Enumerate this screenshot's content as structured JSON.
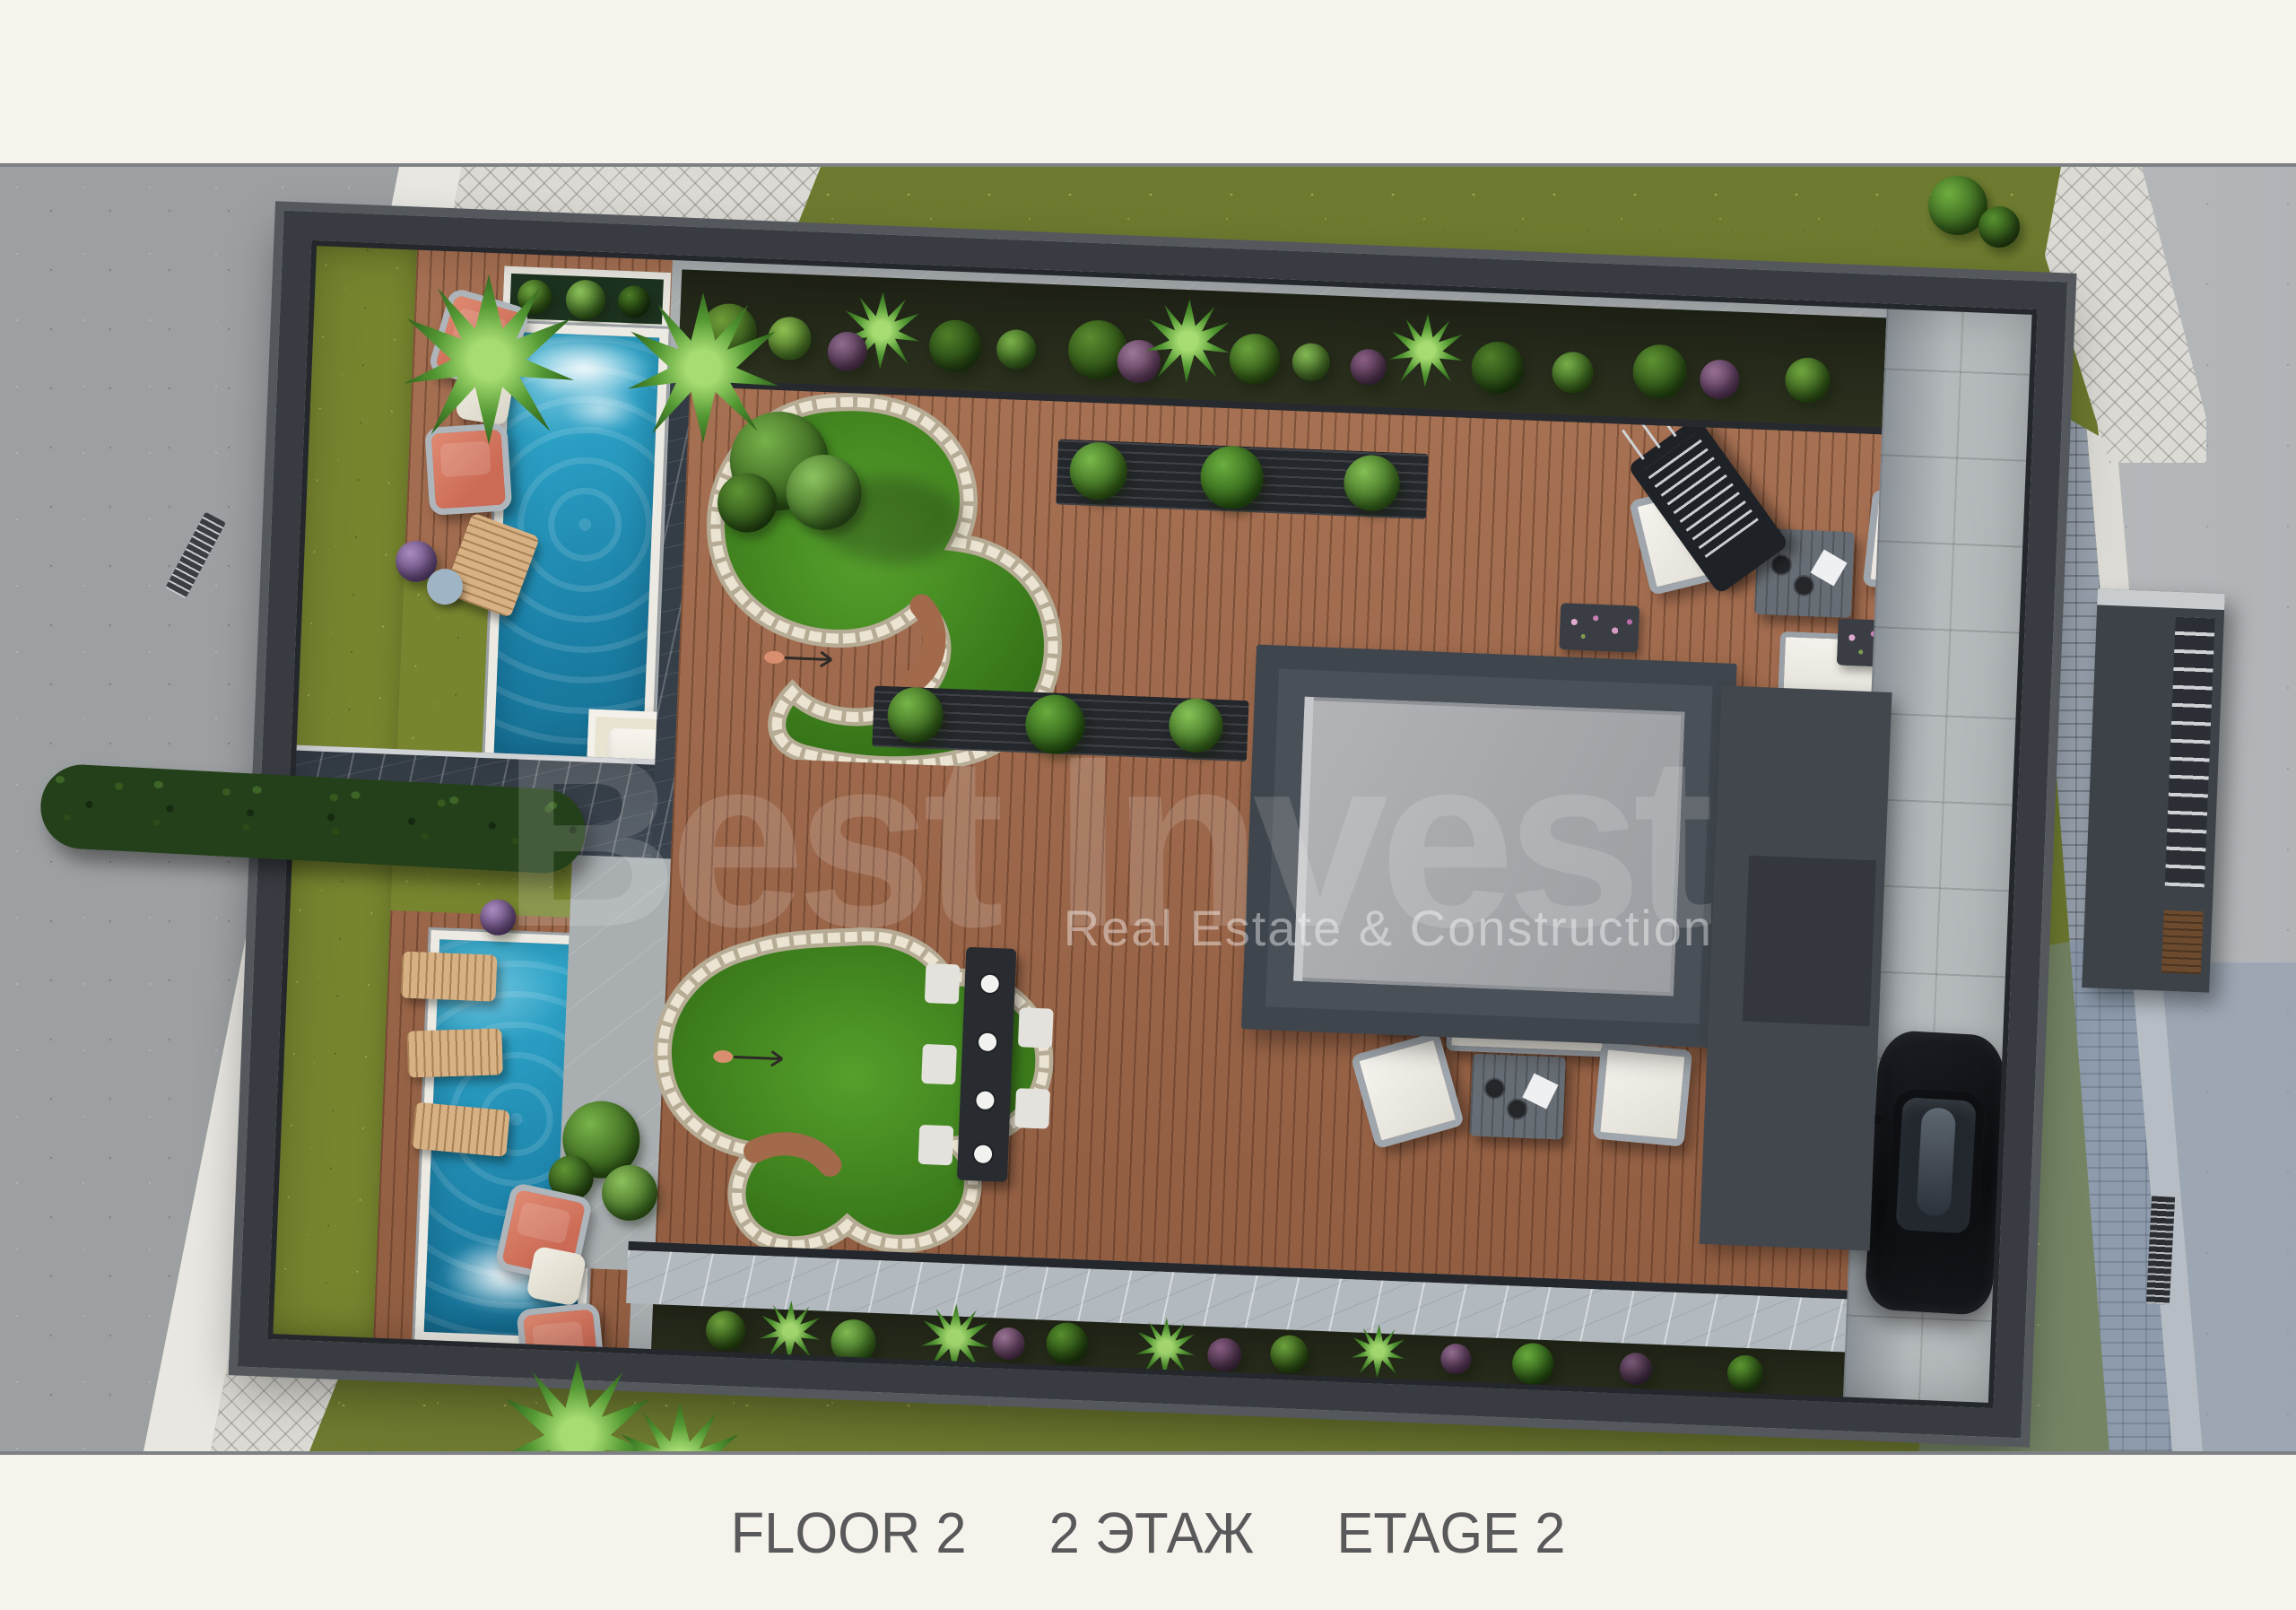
{
  "title": "Villa site plan render — Floor 2",
  "caption": {
    "floor_en": "FLOOR 2",
    "floor_ru": "2 ЭТАЖ",
    "floor_fr": "ETAGE 2"
  },
  "watermark": {
    "brand": "Best Invest",
    "tagline": "Real Estate & Construction"
  },
  "palette": {
    "page_bg": "#f6f3ec",
    "caption_text": "#59585a",
    "grass_outside": "#6d7a2f",
    "grass_inside": "#77852f",
    "pool_water": "#2196bc",
    "deck_wood": "#a2694a",
    "golf_green": "#3f7d20",
    "stone_edge": "#e9e1cf",
    "wall": "#383c42",
    "marble_dark": "#3f4954",
    "marble_light": "#b2b9bf",
    "roof_light": "#a8abaf",
    "building_frame": "#3f454c",
    "road_left": "#9da0a3",
    "road_right": "#babec1",
    "sidewalk": "#dcdad4",
    "accent_coral": "#d4705d",
    "car_black": "#0c0e11",
    "watermark_white": "#ffffff"
  }
}
